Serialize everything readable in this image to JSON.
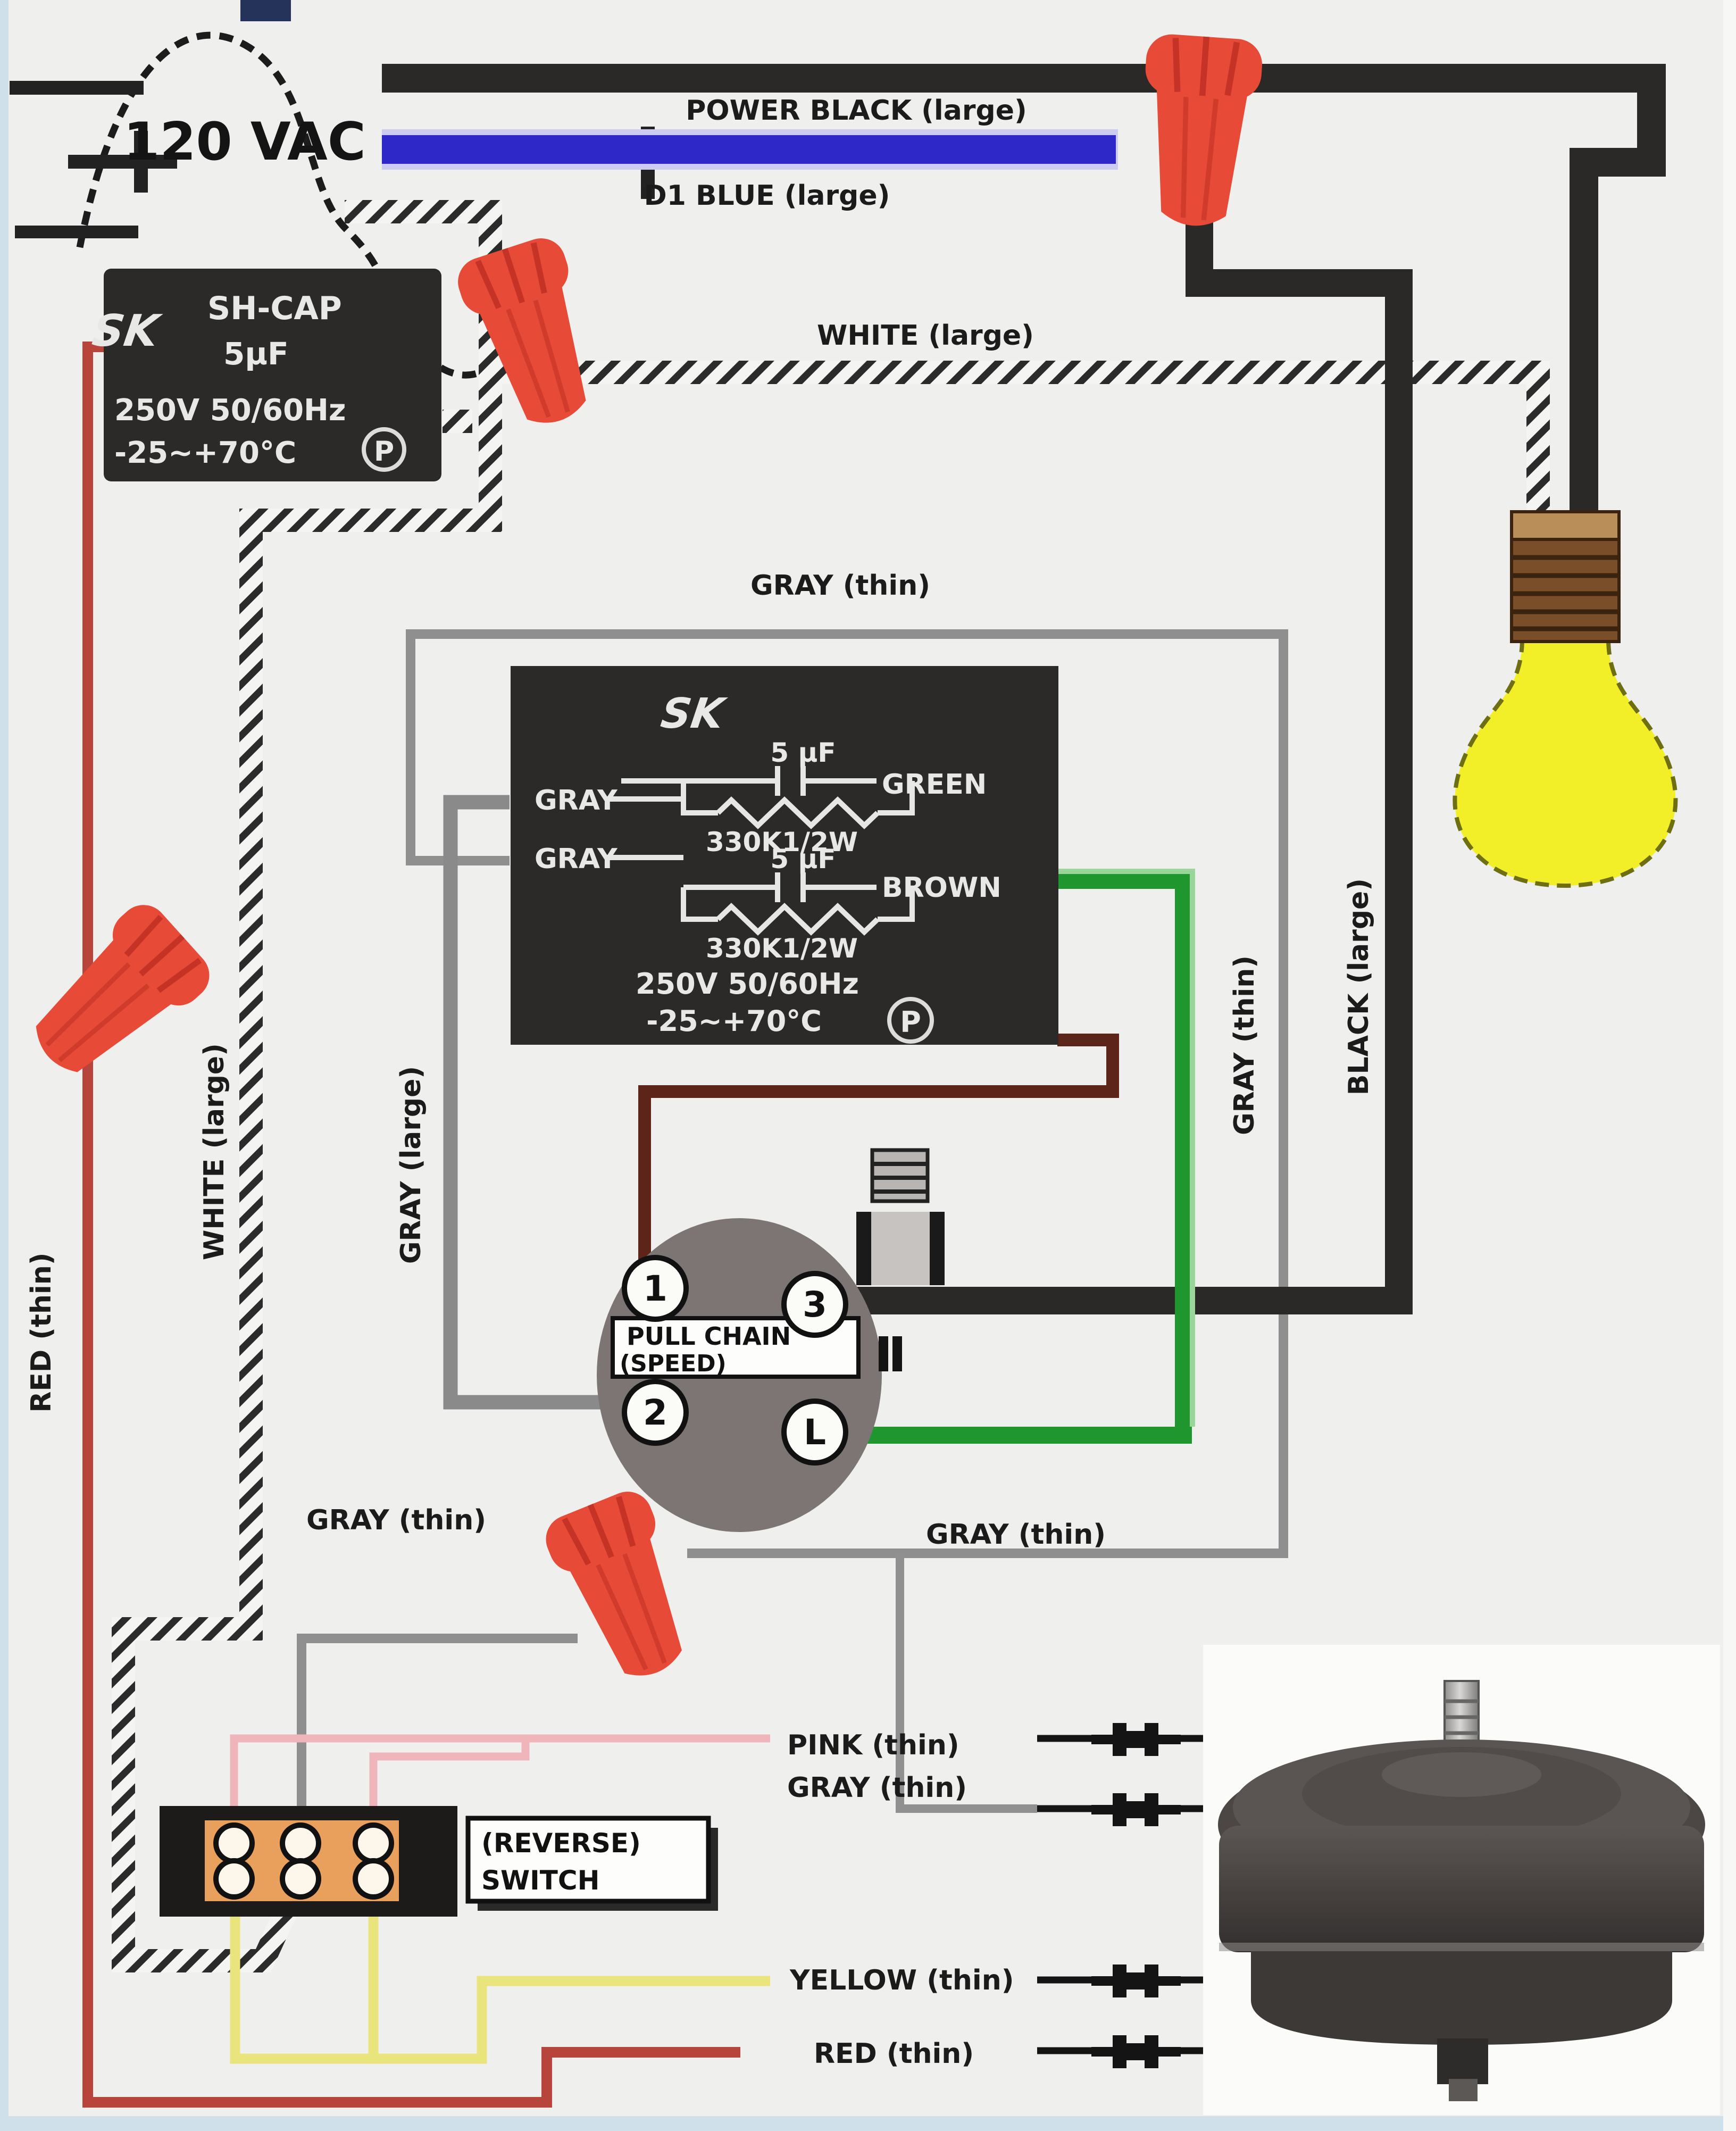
{
  "labels": {
    "source": "120 VAC",
    "power_black": "POWER BLACK (large)",
    "d1_blue": "D1 BLUE (large)",
    "white_large": "WHITE (large)",
    "gray_thin": "GRAY (thin)",
    "gray_large": "GRAY (large)",
    "black_large": "BLACK (large)",
    "red_thin": "RED (thin)",
    "pink_thin": "PINK (thin)",
    "yellow_thin": "YELLOW (thin)"
  },
  "capacitor_main": {
    "logo": "SK",
    "name": "SH-CAP",
    "value": "5µF",
    "rating": "250V 50/60Hz",
    "temp": "-25~+70°C",
    "mark": "P"
  },
  "capacitor_speed": {
    "logo": "SK",
    "uf": "5 µF",
    "gray": "GRAY",
    "green": "GREEN",
    "resistor": "330K1/2W",
    "brown": "BROWN",
    "rating": "250V 50/60Hz",
    "temp": "-25~+70°C",
    "mark": "P"
  },
  "pull_switch": {
    "line1": "PULL CHAIN",
    "line2": "(SPEED)",
    "t1": "1",
    "t2": "2",
    "t3": "3",
    "tL": "L"
  },
  "reverse_switch": {
    "line1": "(REVERSE)",
    "line2": "SWITCH"
  },
  "colors": {
    "black_wire": "#2a2927",
    "blue_wire": "#2f28c9",
    "gray_wire": "#8f8f8f",
    "green_wire": "#1f962e",
    "brown_wire": "#5d251a",
    "red_wire": "#b8453c",
    "pink_wire": "#f0b4bb",
    "yellow_wire": "#e9e47c",
    "wire_nut": "#e84a38",
    "cap_body": "#2b2a28",
    "reverse_inner": "#e8a05c",
    "bulb": "#f2ee28"
  }
}
